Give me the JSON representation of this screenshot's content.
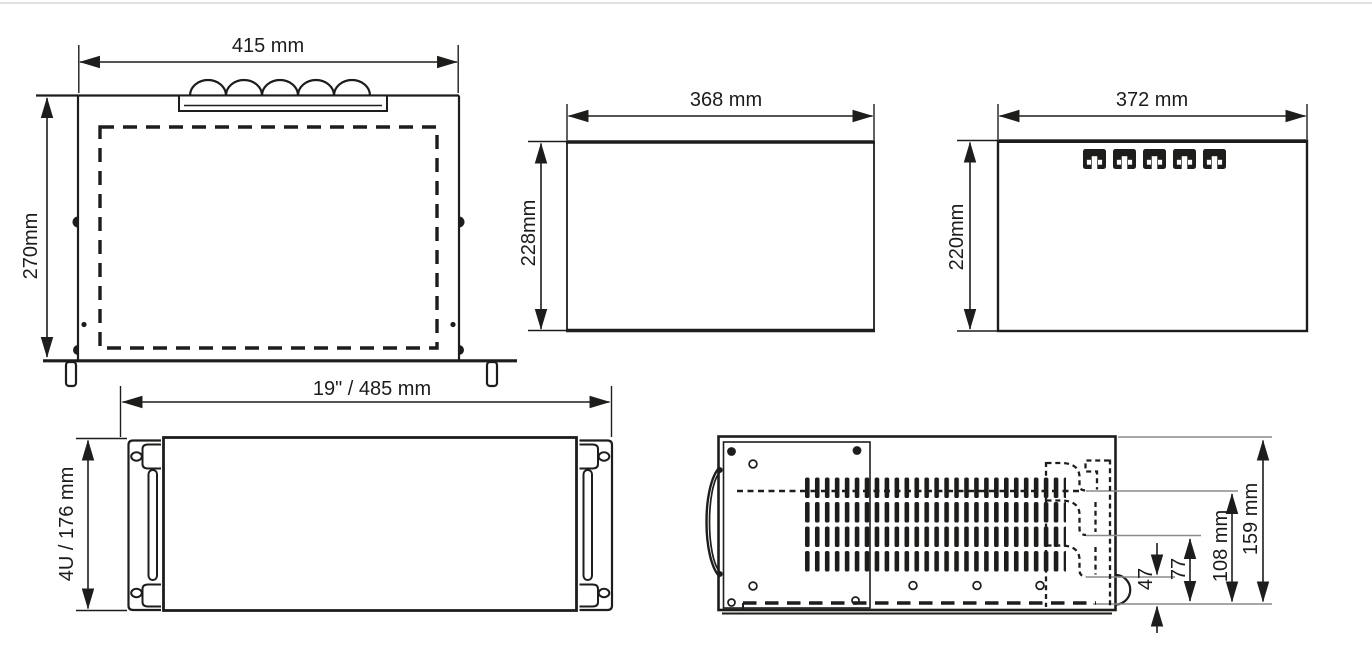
{
  "diagram": {
    "background_color": "#ffffff",
    "line_color": "#1d1d1b",
    "reference_line_color": "#8a8a8a",
    "views": {
      "top": {
        "width": "415 mm",
        "depth": "270mm"
      },
      "side_a": {
        "width": "368 mm",
        "height": "228mm"
      },
      "side_b": {
        "width": "372 mm",
        "height": "220mm"
      },
      "front": {
        "width": "19\" / 485 mm",
        "height": "4U / 176 mm"
      },
      "side_detail": {
        "d159": "159 mm",
        "d108": "108 mm",
        "d77": "77",
        "d47": "47"
      }
    }
  }
}
